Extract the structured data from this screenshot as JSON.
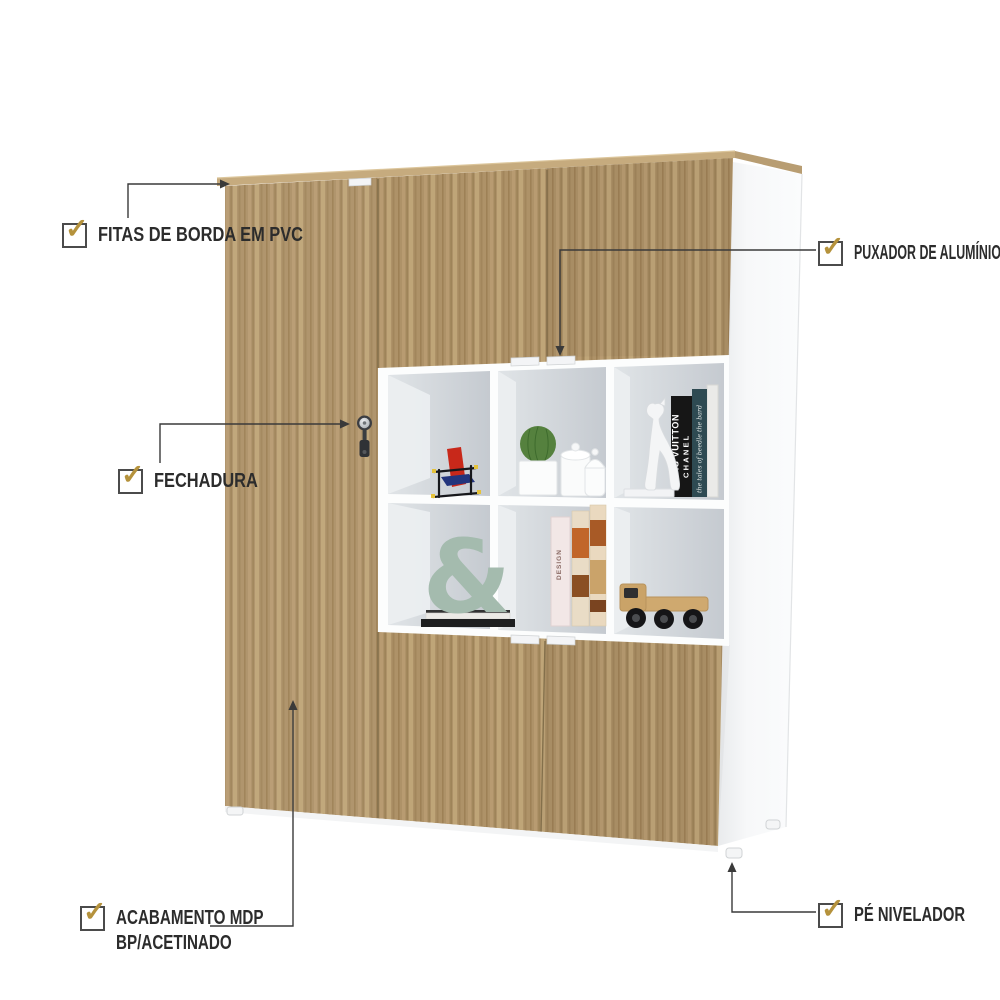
{
  "callouts": {
    "edge_banding": {
      "label": "FITAS DE BORDA EM PVC"
    },
    "handle": {
      "label": "PUXADOR DE ALUMÍNIO"
    },
    "lock": {
      "label": "FECHADURA"
    },
    "finish": {
      "label_line1": "ACABAMENTO MDP",
      "label_line2": "BP/ACETINADO"
    },
    "leveling_foot": {
      "label": "PÉ NIVELADOR"
    }
  },
  "checkbox": {
    "symbol": "✓",
    "check_color": "#b5923c",
    "border_color": "#4b4b4b"
  },
  "shelf_items": {
    "book_black_line1": "LOUIS VUITTON",
    "book_black_line2": "CHANEL",
    "book_teal": "the tales of beedle the bard",
    "book_pink": "DESIGN",
    "ampersand": "&"
  },
  "colors": {
    "wood": "#ae9268",
    "wood_top": "#c6ab7e",
    "label_text": "#2c2c2c",
    "leader_line": "#3a3a3a",
    "shelf_back": "#c9ced4",
    "side_panel": "#f7f8f9"
  }
}
